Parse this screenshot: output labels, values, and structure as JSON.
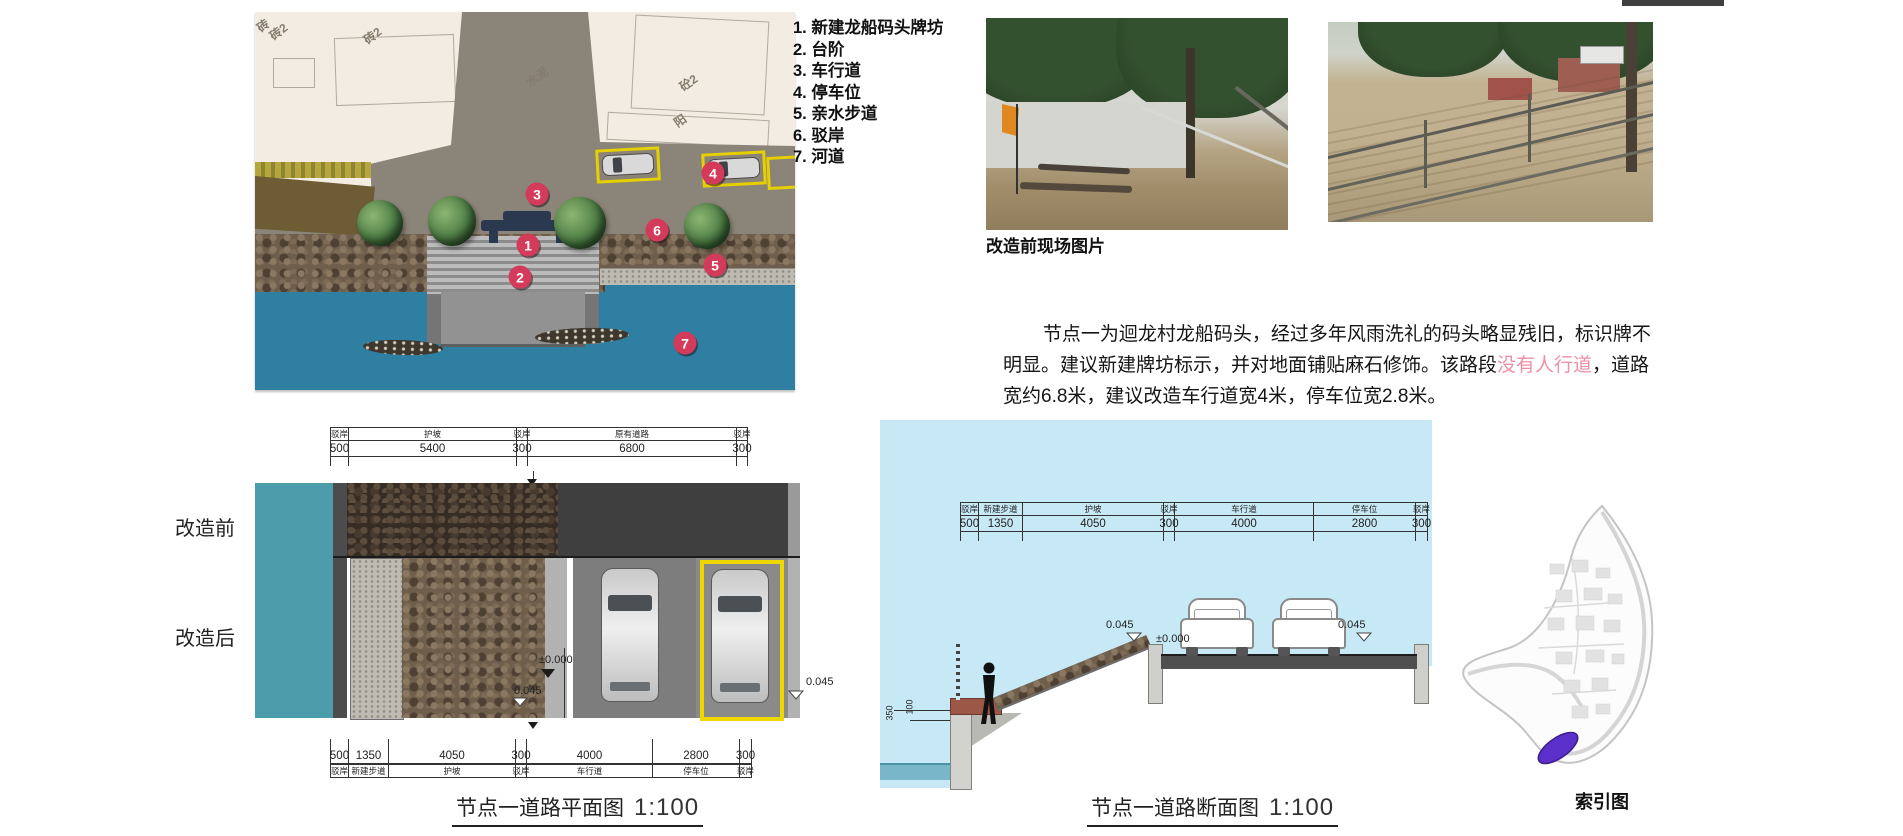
{
  "legend": {
    "items": [
      "1. 新建龙船码头牌坊",
      "2. 台阶",
      "3. 车行道",
      "4. 停车位",
      "5. 亲水步道",
      "6. 驳岸",
      "7. 河道"
    ]
  },
  "site_plan": {
    "markers": [
      {
        "n": "1",
        "x": 273,
        "y": 233
      },
      {
        "n": "2",
        "x": 265,
        "y": 265
      },
      {
        "n": "3",
        "x": 282,
        "y": 182
      },
      {
        "n": "4",
        "x": 458,
        "y": 161
      },
      {
        "n": "5",
        "x": 460,
        "y": 253
      },
      {
        "n": "6",
        "x": 402,
        "y": 218
      },
      {
        "n": "7",
        "x": 430,
        "y": 331
      }
    ],
    "building_labels": [
      {
        "t": "砖",
        "x": 2,
        "y": 5,
        "r": -38
      },
      {
        "t": "砖2",
        "x": 14,
        "y": 11,
        "r": -38
      },
      {
        "t": "砖2",
        "x": 108,
        "y": 15,
        "r": -38
      },
      {
        "t": "水泥",
        "x": 270,
        "y": 56,
        "r": -36
      },
      {
        "t": "砼2",
        "x": 424,
        "y": 62,
        "r": -35
      },
      {
        "t": "阳",
        "x": 419,
        "y": 100,
        "r": -35
      }
    ],
    "marker_color": "#d43a5a"
  },
  "photos": {
    "caption": "改造前现场图片"
  },
  "description": {
    "part1": "节点一为迴龙村龙船码头，经过多年风雨洗礼的码头略显残旧，标识牌不明显。建议新建牌坊标示，并对地面铺贴麻石修饰。该路段",
    "highlight": "没有人行道",
    "part2": "，道路宽约6.8米，建议改造车行道宽4米，停车位宽2.8米。",
    "highlight_color": "#ef8fa6"
  },
  "plan_diagram": {
    "title": "节点一道路平面图",
    "scale": "1:100",
    "label_before": "改造前",
    "label_after": "改造后",
    "top_dims": [
      {
        "label": "驳岸",
        "value": "500",
        "w": 18
      },
      {
        "label": "护坡",
        "value": "5400",
        "w": 168
      },
      {
        "label": "驳岸",
        "value": "300",
        "w": 11
      },
      {
        "label": "原有道路",
        "value": "6800",
        "w": 209
      },
      {
        "label": "驳岸",
        "value": "300",
        "w": 11
      }
    ],
    "bottom_dims": [
      {
        "label": "驳岸",
        "value": "500",
        "w": 18
      },
      {
        "label": "新建步道",
        "value": "1350",
        "w": 40
      },
      {
        "label": "护坡",
        "value": "4050",
        "w": 127
      },
      {
        "label": "驳岸",
        "value": "300",
        "w": 11
      },
      {
        "label": "车行道",
        "value": "4000",
        "w": 126
      },
      {
        "label": "停车位",
        "value": "2800",
        "w": 87
      },
      {
        "label": "驳岸",
        "value": "300",
        "w": 12
      }
    ],
    "elev_zero": "±0.000",
    "elev_045_left": "0.045",
    "elev_045_right": "0.045"
  },
  "section_diagram": {
    "title": "节点一道路断面图",
    "scale": "1:100",
    "dims": [
      {
        "label": "驳岸",
        "value": "500",
        "w": 18
      },
      {
        "label": "新建步道",
        "value": "1350",
        "w": 44
      },
      {
        "label": "护坡",
        "value": "4050",
        "w": 141
      },
      {
        "label": "驳岸",
        "value": "300",
        "w": 11
      },
      {
        "label": "车行道",
        "value": "4000",
        "w": 139
      },
      {
        "label": "停车位",
        "value": "2800",
        "w": 102
      },
      {
        "label": "驳岸",
        "value": "300",
        "w": 12
      }
    ],
    "elev_left": "0.045",
    "elev_zero": "±0.000",
    "elev_right": "0.045",
    "dim_350": "350",
    "dim_100": "100"
  },
  "index_map": {
    "caption": "索引图",
    "marker_color": "#5b2fc9"
  }
}
